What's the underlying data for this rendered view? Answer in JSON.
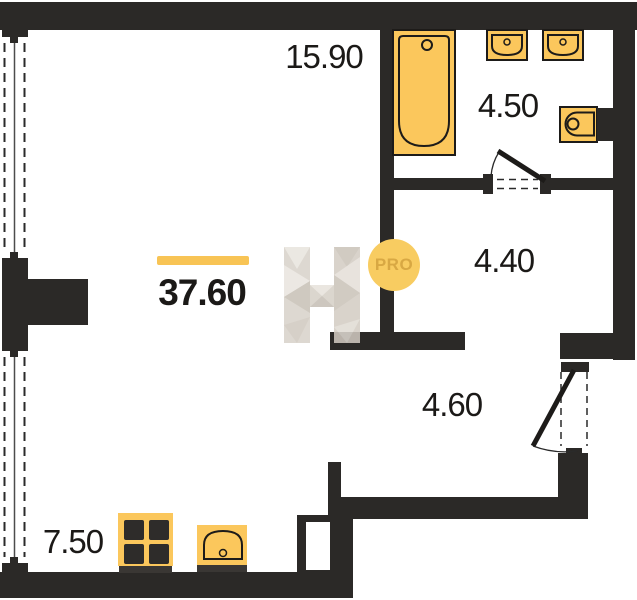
{
  "plan": {
    "title": "apartment-floor-plan",
    "rooms": [
      {
        "id": "living-room",
        "area": "37.60",
        "highlighted": true
      },
      {
        "id": "top-room",
        "area": "15.90"
      },
      {
        "id": "bathroom",
        "area": "4.50"
      },
      {
        "id": "hall",
        "area": "4.40"
      },
      {
        "id": "corridor",
        "area": "4.60"
      },
      {
        "id": "kitchen",
        "area": "7.50"
      }
    ],
    "fixtures": [
      "bathtub",
      "washbasin",
      "washbasin",
      "toilet",
      "stove",
      "kitchen-sink"
    ],
    "doors": [
      "bathroom-door",
      "entry-door"
    ],
    "windows": [
      "window-upper-left",
      "window-lower-left"
    ],
    "watermark": {
      "pro_label": "PRO",
      "logo": "h-logo"
    },
    "colors": {
      "wall": "#2b2927",
      "background": "#ffffff",
      "label": "#1b1917",
      "line": "#2a2a2a",
      "fixture_fill": "#fbc75c",
      "fixture_outline": "#1d1b19",
      "highlight": "#f8c455",
      "watermark_circle": "#f8cc61",
      "watermark_text": "#d8a843",
      "appliance_dark": "#2e2c2a",
      "base_strip": "#3a3734"
    }
  }
}
